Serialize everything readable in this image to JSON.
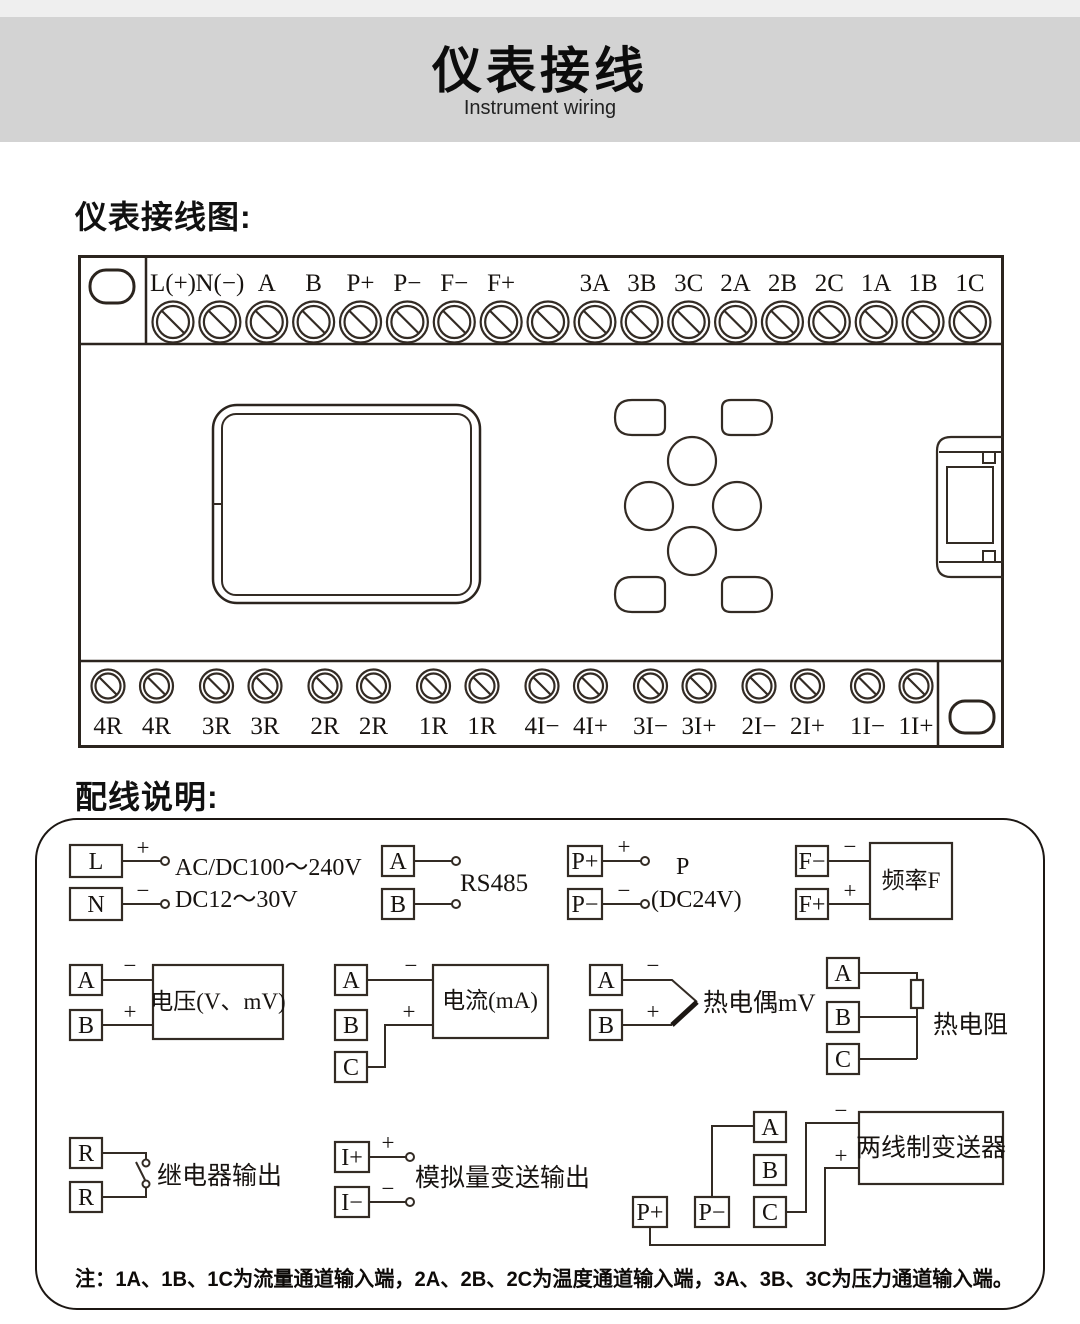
{
  "header": {
    "title": "仪表接线",
    "subtitle": "Instrument wiring"
  },
  "sections": {
    "diagram_heading": "仪表接线图:",
    "wiring_heading": "配线说明:"
  },
  "terminal_block": {
    "top_labels": [
      "L(+)",
      "N(−)",
      "A",
      "B",
      "P+",
      "P−",
      "F−",
      "F+",
      "",
      "3A",
      "3B",
      "3C",
      "2A",
      "2B",
      "2C",
      "1A",
      "1B",
      "1C"
    ],
    "bottom_labels": [
      "4R",
      "4R",
      "3R",
      "3R",
      "2R",
      "2R",
      "1R",
      "1R",
      "4I−",
      "4I+",
      "3I−",
      "3I+",
      "2I−",
      "2I+",
      "1I−",
      "1I+"
    ]
  },
  "wiring": {
    "power": {
      "t1": "L",
      "t2": "N",
      "plus": "+",
      "minus": "−",
      "line1": "AC/DC100～240V",
      "line2": "DC12～30V"
    },
    "rs485": {
      "t1": "A",
      "t2": "B",
      "label": "RS485"
    },
    "p24": {
      "t1": "P+",
      "t2": "P−",
      "plus": "+",
      "minus": "−",
      "label1": "P",
      "label2": "(DC24V)"
    },
    "freq": {
      "t1": "F−",
      "t2": "F+",
      "plus": "+",
      "minus": "−",
      "box": "频率F"
    },
    "voltage": {
      "t1": "A",
      "t2": "B",
      "plus": "+",
      "minus": "−",
      "box": "电压(V、mV)"
    },
    "current": {
      "t1": "A",
      "t2": "B",
      "t3": "C",
      "plus": "+",
      "minus": "−",
      "box": "电流(mA)"
    },
    "thermocouple": {
      "t1": "A",
      "t2": "B",
      "plus": "+",
      "minus": "−",
      "label": "热电偶mV"
    },
    "rtd": {
      "t1": "A",
      "t2": "B",
      "t3": "C",
      "label": "热电阻"
    },
    "relay": {
      "t1": "R",
      "t2": "R",
      "label": "继电器输出"
    },
    "analog_out": {
      "t1": "I+",
      "t2": "I−",
      "plus": "+",
      "minus": "−",
      "label": "模拟量变送输出"
    },
    "transmitter": {
      "p_plus": "P+",
      "p_minus": "P−",
      "a": "A",
      "b": "B",
      "c": "C",
      "plus": "+",
      "minus": "−",
      "box": "两线制变送器"
    }
  },
  "note": "注：1A、1B、1C为流量通道输入端，2A、2B、2C为温度通道输入端，3A、3B、3C为压力通道输入端。",
  "colors": {
    "line": "#332b24",
    "banner_bg": "#d3d3d3",
    "text": "#171310"
  }
}
